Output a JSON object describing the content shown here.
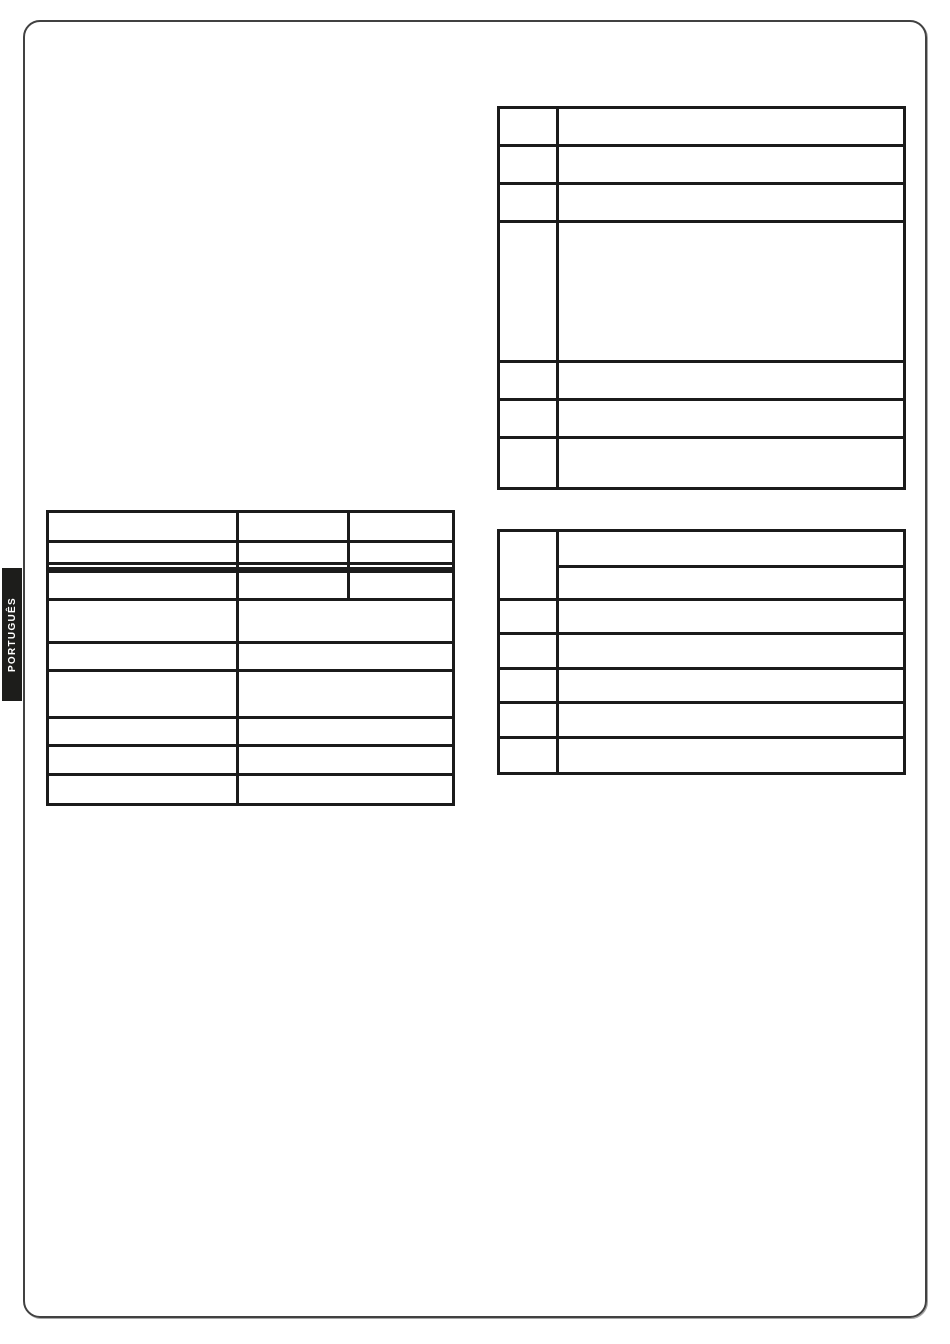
{
  "language_tab": {
    "label": "PORTUGUÊS"
  },
  "colors": {
    "page_background": "#ffffff",
    "page_border": "#414141",
    "tab_background": "#1d1d1b",
    "tab_text": "#ffffff",
    "table_border": "#1b1b1b"
  },
  "tables": {
    "left_spec_table": {
      "columns": 3,
      "rows": 9,
      "visible_text": ""
    },
    "top_right_table": {
      "columns": 2,
      "rows": 7,
      "visible_text": ""
    },
    "mid_right_table": {
      "columns": 2,
      "rows": 7,
      "visible_text": ""
    }
  }
}
